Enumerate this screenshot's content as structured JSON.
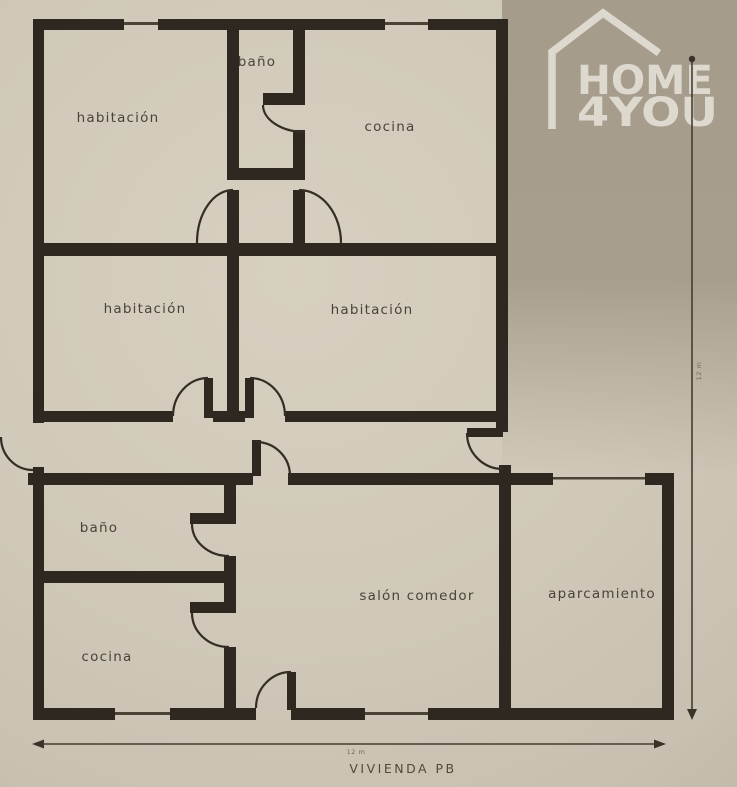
{
  "floor_plan": {
    "title": "VIVIENDA PB",
    "rooms": [
      {
        "id": "habitacion-top-left",
        "label": "habitación"
      },
      {
        "id": "bano-top",
        "label": "baño"
      },
      {
        "id": "cocina-top",
        "label": "cocina"
      },
      {
        "id": "habitacion-mid-left",
        "label": "habitación"
      },
      {
        "id": "habitacion-mid-right",
        "label": "habitación"
      },
      {
        "id": "bano-bottom",
        "label": "baño"
      },
      {
        "id": "cocina-bottom",
        "label": "cocina"
      },
      {
        "id": "salon-comedor",
        "label": "salón comedor"
      },
      {
        "id": "aparcamiento",
        "label": "aparcamiento"
      }
    ],
    "dimension_annotations": {
      "bottom": "12 m",
      "right": "12 m"
    }
  },
  "logo": {
    "line1": "HOME",
    "line2": "4YOU"
  },
  "colors": {
    "wall": "#2e2821",
    "paper": "#d0c9b9",
    "paper_shaded": "#a89e8e",
    "label_text": "#4a4437",
    "logo": "#e8e4da",
    "dimension_line": "#453e30"
  }
}
